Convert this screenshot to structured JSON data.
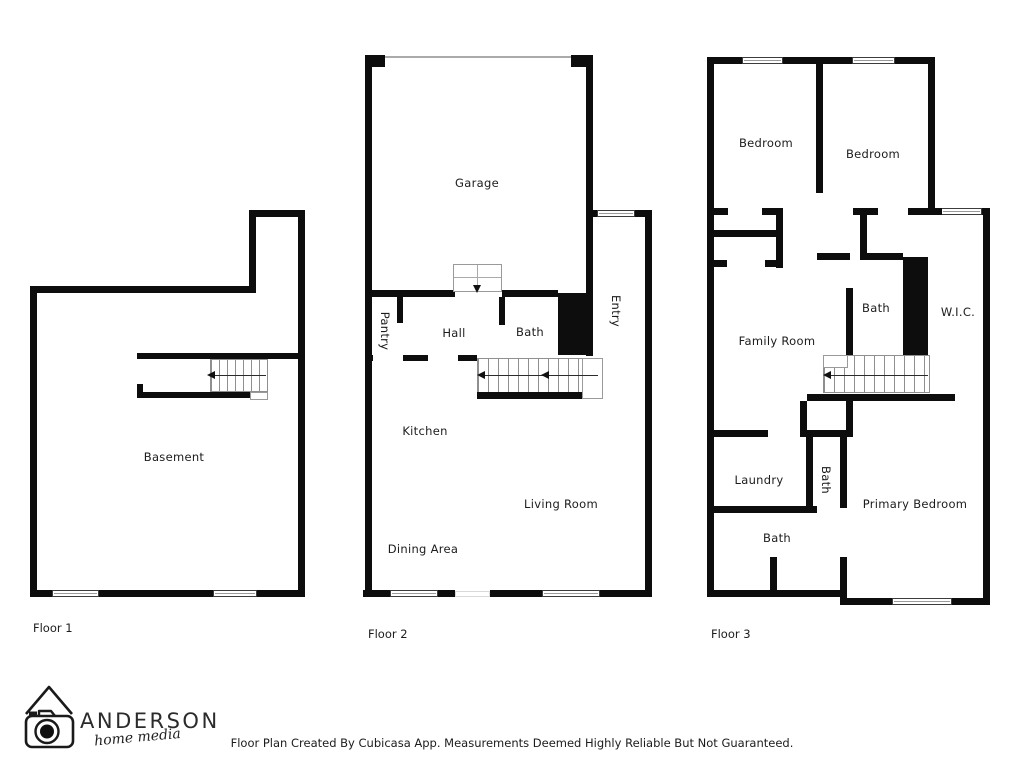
{
  "page": {
    "footer_credit": "Floor Plan Created By Cubicasa App. Measurements Deemed Highly Reliable But Not Guaranteed."
  },
  "logo": {
    "brand": "ANDERSON",
    "tagline": "home media",
    "icon": "house-camera-icon"
  },
  "colors": {
    "walls": "#0d0d0d",
    "background": "#ffffff",
    "text": "#1c1c1c"
  },
  "floors": [
    {
      "label": "Floor 1",
      "rooms": [
        {
          "name": "Basement"
        }
      ]
    },
    {
      "label": "Floor 2",
      "rooms": [
        {
          "name": "Garage"
        },
        {
          "name": "Pantry"
        },
        {
          "name": "Hall"
        },
        {
          "name": "Bath"
        },
        {
          "name": "Entry"
        },
        {
          "name": "Kitchen"
        },
        {
          "name": "Living Room"
        },
        {
          "name": "Dining Area"
        }
      ]
    },
    {
      "label": "Floor 3",
      "rooms": [
        {
          "name": "Bedroom"
        },
        {
          "name": "Bedroom"
        },
        {
          "name": "Bath"
        },
        {
          "name": "W.I.C."
        },
        {
          "name": "Family Room"
        },
        {
          "name": "Laundry"
        },
        {
          "name": "Bath"
        },
        {
          "name": "Bath"
        },
        {
          "name": "Primary Bedroom"
        }
      ]
    }
  ]
}
